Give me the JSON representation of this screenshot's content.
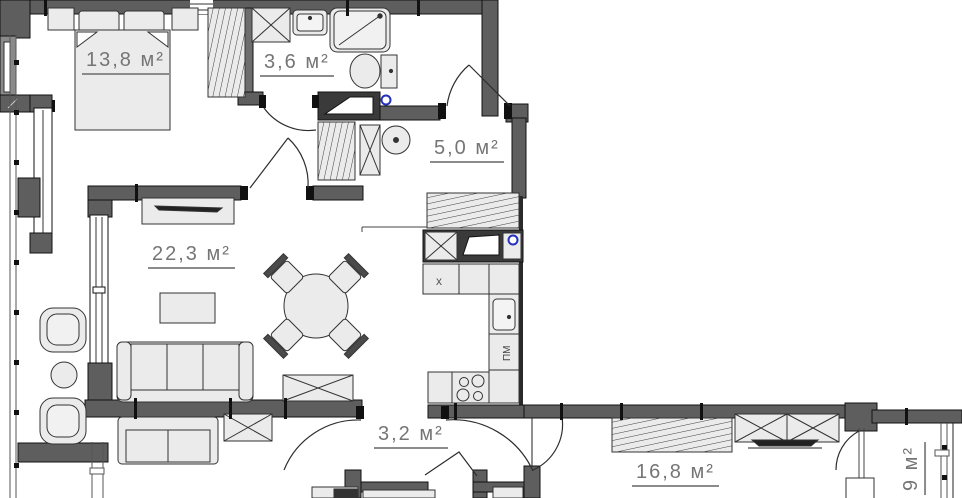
{
  "plan": {
    "title": "Apartment floor plan",
    "area_unit": "м²",
    "rooms": [
      {
        "id": "bedroom",
        "area_label": "13,8 м²"
      },
      {
        "id": "bathroom",
        "area_label": "3,6 м²"
      },
      {
        "id": "hallway",
        "area_label": "5,0 м²"
      },
      {
        "id": "living-room",
        "area_label": "22,3 м²"
      },
      {
        "id": "corridor",
        "area_label": "3,2 м²"
      },
      {
        "id": "bedroom-2",
        "area_label": "16,8 м²"
      },
      {
        "id": "balcony-2",
        "area_label": "9 м²"
      }
    ],
    "annotations": {
      "vent_box_label": "x",
      "dishwasher_label": "ПМ"
    },
    "colors": {
      "wall": "#5e5e5e",
      "wall_dark": "#3a3a3a",
      "furniture_fill": "#ebebeb",
      "label_text": "#757575",
      "riser_blue": "#2230bb",
      "background": "#ffffff"
    }
  }
}
